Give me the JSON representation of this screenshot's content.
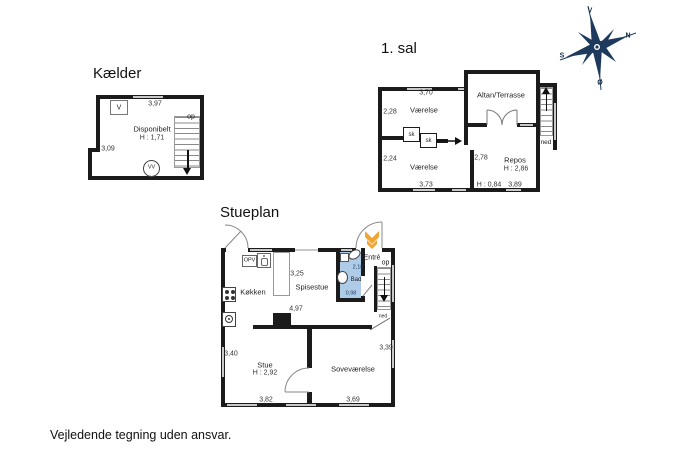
{
  "disclaimer": "Vejledende tegning uden ansvar.",
  "compass": {
    "west": "V",
    "north": "N",
    "south": "S",
    "east": "Ø"
  },
  "kaelder": {
    "title": "Kælder",
    "room_name": "Disponibelt",
    "room_height": "H : 1,71",
    "vent_label": "V",
    "boiler_label": "VV",
    "stairs_label": "op",
    "dim_top": "3,97",
    "dim_left": "3,09"
  },
  "first_floor": {
    "title": "1. sal",
    "room_n": "Værelse",
    "room_s": "Værelse",
    "altan": "Altan/Terrasse",
    "repos": "Repos",
    "repos_height": "H : 2,86",
    "closet1": "sk",
    "closet2": "sk",
    "stairs_label": "ned",
    "dim_top": "3,70",
    "dim_left_n": "2,28",
    "dim_left_s": "2,24",
    "dim_bottom_s": "3,73",
    "dim_repos_w": "2,78",
    "dim_bottom_h": "H : 0,84",
    "dim_bottom_r": "3,89"
  },
  "stueplan": {
    "title": "Stueplan",
    "koekken": "Køkken",
    "spisestue": "Spisestue",
    "bad": "Bad",
    "entre": "Entré",
    "stue": "Stue",
    "stue_height": "H : 2,92",
    "sovevaerelse": "Soveværelse",
    "opv_label": "OPV",
    "stairs_up": "op",
    "stairs_down": "ned",
    "dim_spisestue": "3,25",
    "dim_mid": "4,97",
    "dim_stue_h": "3,40",
    "dim_stue_w": "3,82",
    "dim_sove_w": "3,69",
    "dim_sove_h": "3,39",
    "dim_bad_h": "2,18",
    "dim_bad_w": "0,98"
  }
}
